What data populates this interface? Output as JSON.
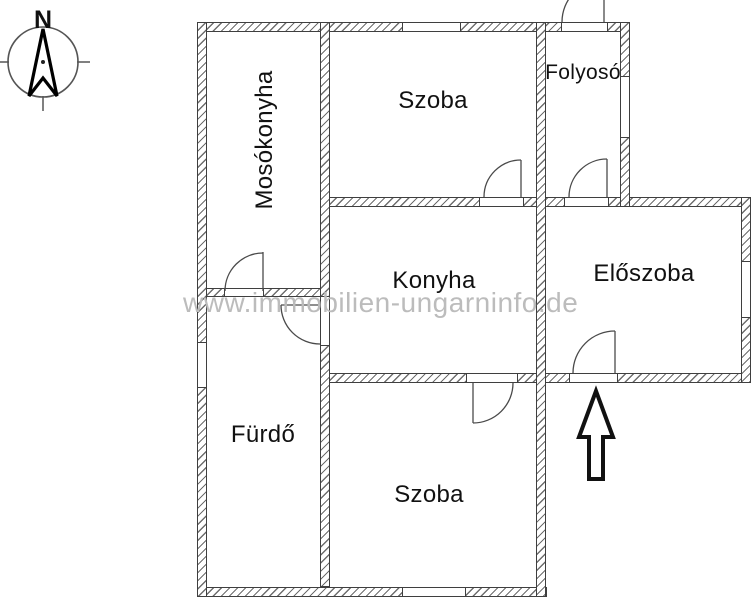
{
  "compass": {
    "label": "N"
  },
  "rooms": {
    "mosokonyha": {
      "label": "Mosókonyha"
    },
    "szoba_top": {
      "label": "Szoba"
    },
    "folyoso": {
      "label": "Folyosó"
    },
    "konyha": {
      "label": "Konyha"
    },
    "eloszoba": {
      "label": "Előszoba"
    },
    "furdo": {
      "label": "Fürdő"
    },
    "szoba_bottom": {
      "label": "Szoba"
    }
  },
  "watermark": {
    "text": "www.immobilien-ungarninfo.de"
  },
  "icons": {
    "compass": "compass-north-icon",
    "entrance_arrow": "entrance-arrow-icon"
  },
  "colors": {
    "background": "#ffffff",
    "wall_line": "#3f3f3f",
    "hatch": "#6e6e6e",
    "door_line": "#4a4a4a",
    "text": "#111111",
    "watermark": "#bcbcbc"
  }
}
